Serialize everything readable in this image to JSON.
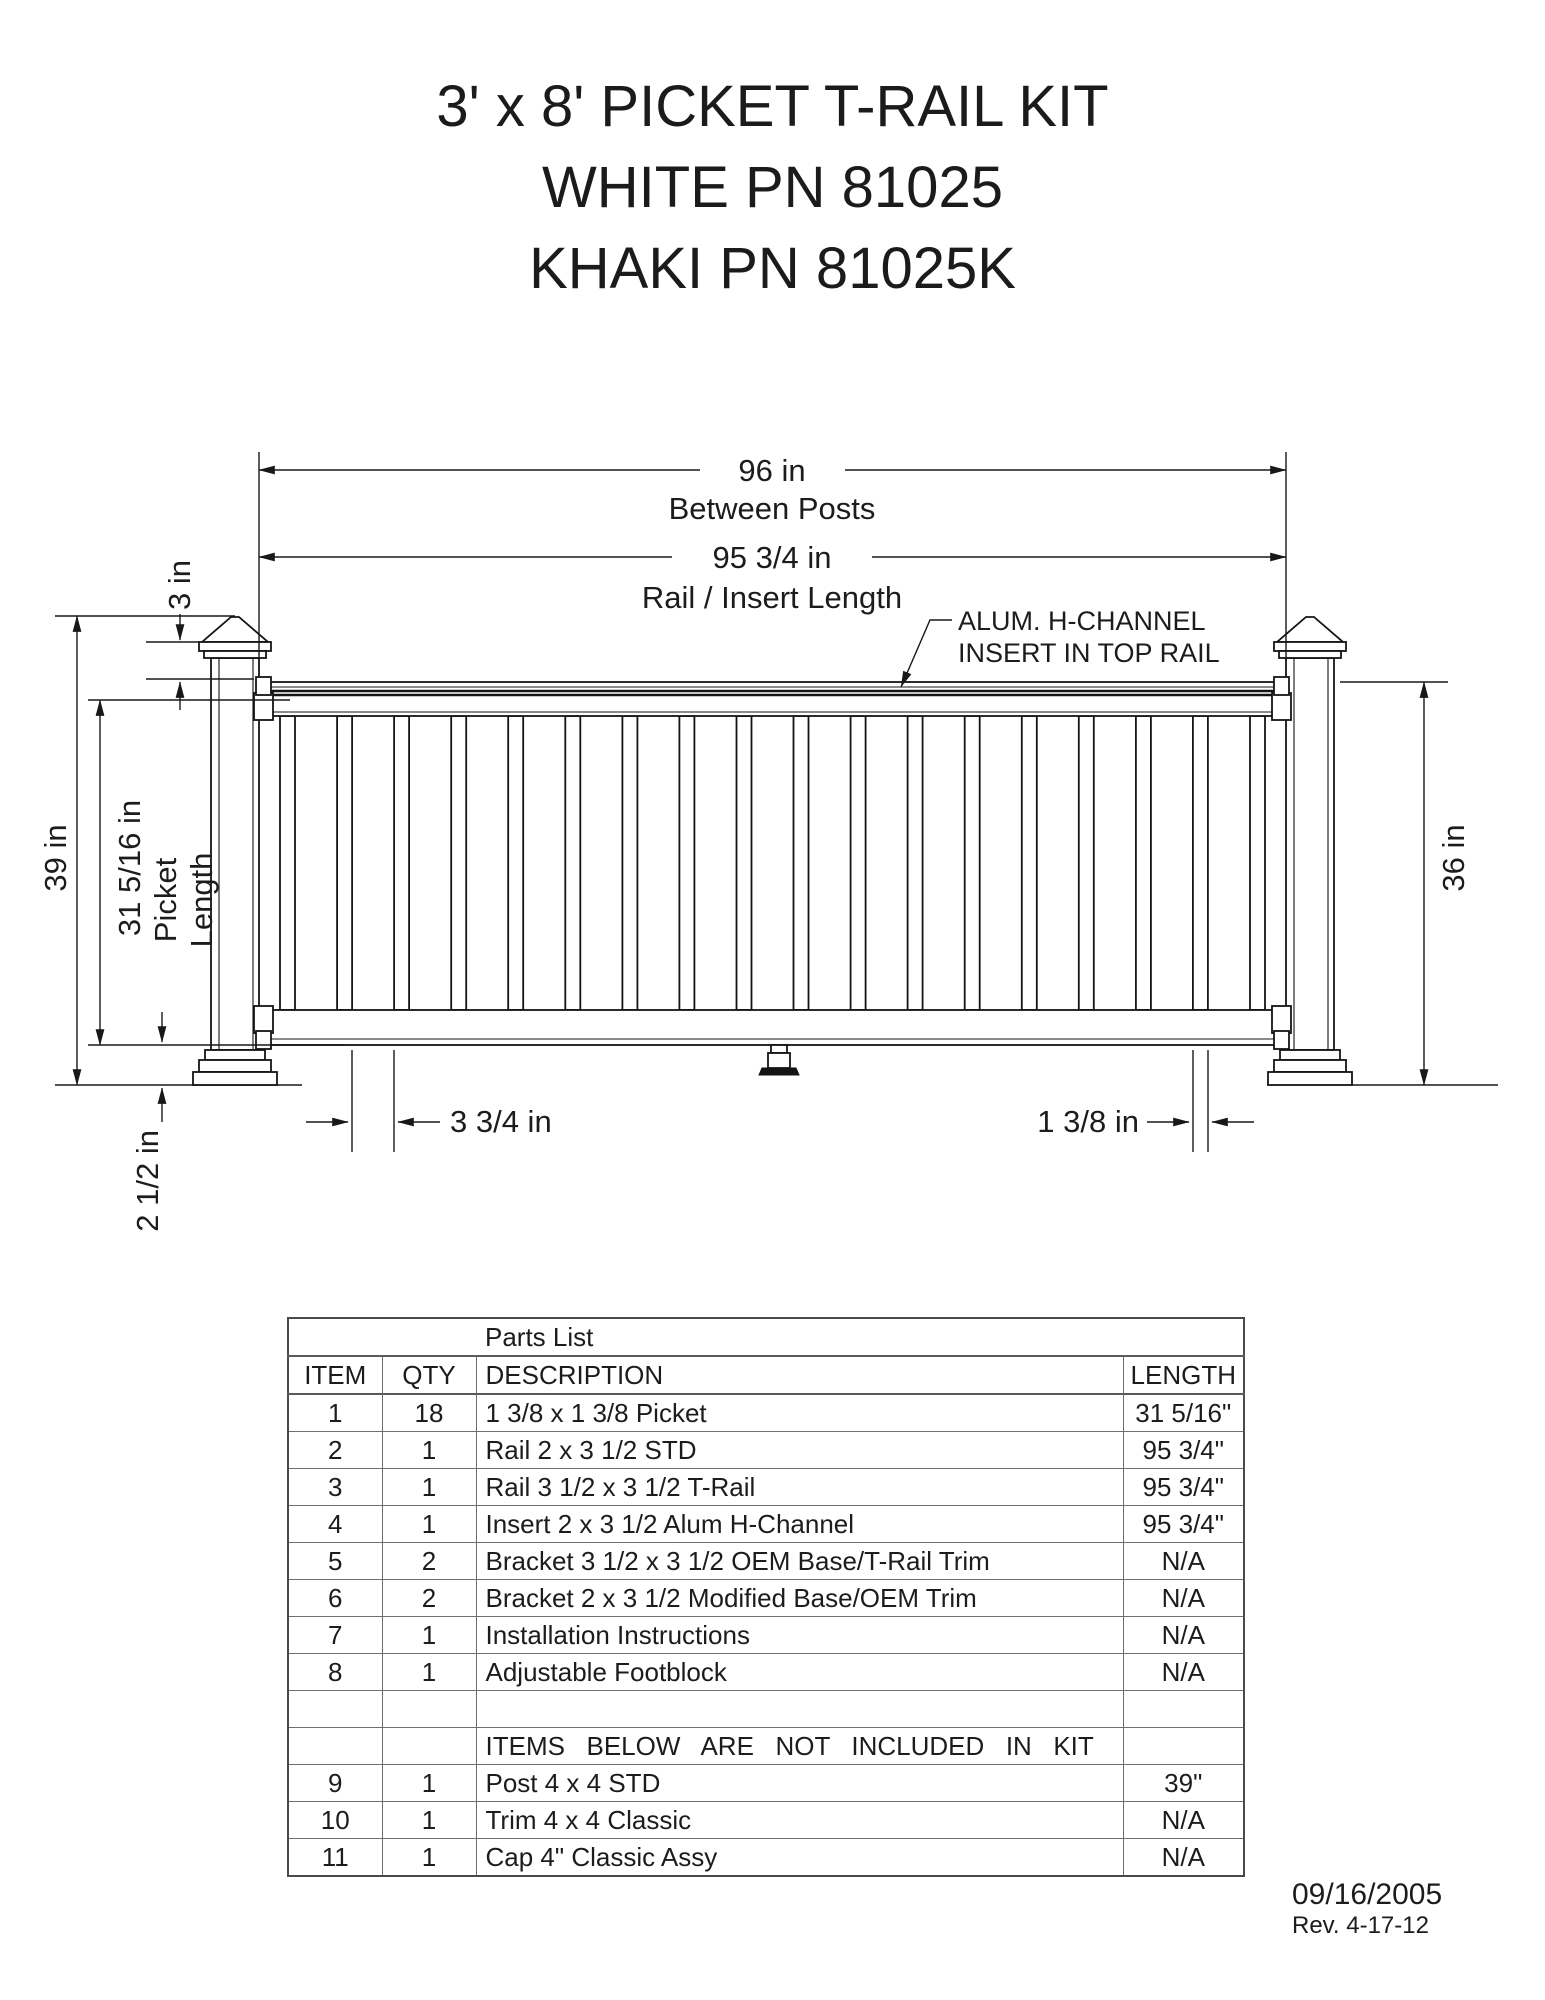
{
  "title": {
    "line1": "3' x 8' PICKET T-RAIL KIT",
    "line2": "WHITE PN 81025",
    "line3": "KHAKI PN 81025K"
  },
  "diagram": {
    "picket_count": 18,
    "dims": {
      "between_posts_value": "96 in",
      "between_posts_label": "Between Posts",
      "rail_insert_value": "95 3/4 in",
      "rail_insert_label": "Rail / Insert Length",
      "cap_offset": "3 in",
      "post_height": "39 in",
      "picket_length_value": "31 5/16 in",
      "picket_length_label1": "Picket",
      "picket_length_label2": "Length",
      "rail_top_height": "36 in",
      "ground_clearance": "2 1/2 in",
      "picket_gap": "3 3/4 in",
      "picket_width": "1 3/8 in"
    },
    "callout": {
      "line1": "ALUM. H-CHANNEL",
      "line2": "INSERT IN TOP RAIL"
    }
  },
  "parts_list": {
    "title": "Parts List",
    "columns": [
      "ITEM",
      "QTY",
      "DESCRIPTION",
      "LENGTH"
    ],
    "rows": [
      {
        "item": "1",
        "qty": "18",
        "description": "1 3/8 x 1 3/8 Picket",
        "length": "31 5/16\""
      },
      {
        "item": "2",
        "qty": "1",
        "description": "Rail 2 x 3 1/2 STD",
        "length": "95 3/4\""
      },
      {
        "item": "3",
        "qty": "1",
        "description": "Rail 3 1/2 x 3 1/2 T-Rail",
        "length": "95 3/4\""
      },
      {
        "item": "4",
        "qty": "1",
        "description": "Insert 2 x 3 1/2 Alum H-Channel",
        "length": "95 3/4\""
      },
      {
        "item": "5",
        "qty": "2",
        "description": "Bracket 3 1/2 x 3 1/2 OEM Base/T-Rail Trim",
        "length": "N/A"
      },
      {
        "item": "6",
        "qty": "2",
        "description": "Bracket 2 x 3 1/2 Modified Base/OEM Trim",
        "length": "N/A"
      },
      {
        "item": "7",
        "qty": "1",
        "description": "Installation Instructions",
        "length": "N/A"
      },
      {
        "item": "8",
        "qty": "1",
        "description": "Adjustable Footblock",
        "length": "N/A"
      },
      {
        "type": "empty"
      },
      {
        "type": "section",
        "description": "ITEMS BELOW ARE NOT INCLUDED IN KIT"
      },
      {
        "item": "9",
        "qty": "1",
        "description": "Post 4 x 4 STD",
        "length": "39\""
      },
      {
        "item": "10",
        "qty": "1",
        "description": "Trim 4 x 4 Classic",
        "length": "N/A"
      },
      {
        "item": "11",
        "qty": "1",
        "description": "Cap 4\" Classic Assy",
        "length": "N/A"
      }
    ]
  },
  "footer": {
    "date": "09/16/2005",
    "revision": "Rev. 4-17-12"
  }
}
